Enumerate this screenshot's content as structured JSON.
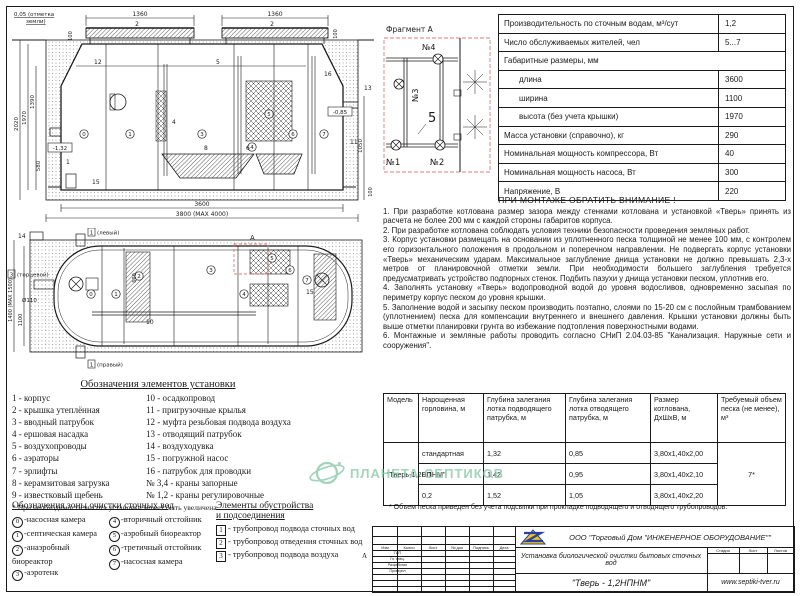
{
  "side_view": {
    "ground1": "0,05 (отметка",
    "ground2": "земли)",
    "dim_top_left": "1360",
    "dim_top_right": "1360",
    "lid_left": "2",
    "lid_right": "2",
    "d100l": "100",
    "d100r": "100",
    "d2020": "2020",
    "d1970": "1970",
    "d1390": "1390",
    "d580": "580",
    "inlet_depth": "-1,32",
    "outlet_depth": "-0,85",
    "d1050": "1050",
    "d100br": "100",
    "d3600": "3600",
    "d3800": "3800 (МАХ 4000)",
    "labels": {
      "n12": "12",
      "n5": "5",
      "n16": "16",
      "n13": "13",
      "n11": "11",
      "n1": "1",
      "n15": "15",
      "n4": "4",
      "n8": "8",
      "n6": "6"
    }
  },
  "plan_view": {
    "d1400": "1400 (МАХ 1500)",
    "d1100": "1100",
    "d600": "600",
    "dia110": "Ø110",
    "n14": "14",
    "n10": "10",
    "n15": "15",
    "end_num": "3",
    "end_label": "(торцевой)",
    "top_num": "1",
    "top_label": "(левый)",
    "bottom_num": "1",
    "bottom_label": "(правый)",
    "mark": "А"
  },
  "fragment": {
    "title": "Фрагмент А",
    "v1": "№1",
    "v2": "№2",
    "v3": "№3",
    "v4": "№4",
    "n5": "5"
  },
  "spec_table": {
    "rows": [
      {
        "label": "Производительность по сточным водам, м³/сут",
        "value": "1,2"
      },
      {
        "label": "Число обслуживаемых жителей, чел",
        "value": "5...7"
      },
      {
        "label": "Габаритные размеры, мм",
        "value": ""
      },
      {
        "label": "длина",
        "value": "3600"
      },
      {
        "label": "ширина",
        "value": "1100"
      },
      {
        "label": "высота (без учета крышки)",
        "value": "1970"
      },
      {
        "label": "Масса установки (справочно), кг",
        "value": "290"
      },
      {
        "label": "Номинальная мощность компрессора, Вт",
        "value": "40"
      },
      {
        "label": "Номинальная мощность насоса, Вт",
        "value": "300"
      },
      {
        "label": "Напряжение, В",
        "value": "220"
      }
    ]
  },
  "notice": {
    "title": "ПРИ МОНТАЖЕ ОБРАТИТЬ ВНИМАНИЕ !",
    "paragraphs": [
      "1. При разработке котлована размер зазора между стенками котлована и установкой «Тверь» принять из расчета не более 200 мм с каждой стороны габаритов корпуса.",
      "2. При разработке котлована соблюдать условия техники безопасности проведения земляных работ.",
      "3. Корпус установки размещать на основании из уплотненного песка толщиной не менее 100 мм, с контролем его горизонтального положения в продольном и поперечном направлении. Не подвергать корпус установки «Тверь» механическим ударам. Максимальное заглубление днища установки не должно превышать 2,3-х метров от планировочной отметки земли. При необходимости большего заглубления требуется предусматривать устройство подпорных стенок.  Подбить пазухи у днища установки песком, уплотнив его.",
      "4. Заполнять установку «Тверь» водопроводной водой до уровня водосливов, одновременно засыпая по периметру корпус песком до уровня крышки.",
      "5. Заполнение водой и засыпку песком производить поэтапно, слоями по 15-20 см с послойным трамбованием (уплотнением) песка для компенсации внутреннего и внешнего давления. Крышки установки должны быть выше отметки планировки грунта во избежание подтопления поверхностными водами.",
      "6. Монтажные и земляные работы проводить согласно СНиП 2.04.03-85 \"Канализация. Наружные сети и сооружения\"."
    ]
  },
  "legend_elements": {
    "title": "Обозначения элементов установки",
    "col1": [
      "1 - корпус",
      "2 - крышка утеплённая",
      "3 - вводный патрубок",
      "4 - ершовая насадка",
      "5 - воздухопроводы",
      "6 - аэраторы",
      "7 - эрлифты",
      "8 - керамзитовая загрузка",
      "9 - известковый щебень"
    ],
    "col2": [
      "10 - осадкопровод",
      "11 - пригрузочные крылья",
      "12 - муфта резьбовая подвода воздуха",
      "13 - отводящий патрубок",
      "14 - воздуходувка",
      "15 - погружной насос",
      "16 - патрубок для проводки",
      "№ 3,4 - краны запорные",
      "№ 1,2 - краны регулировочные"
    ],
    "footnote": "* При необходимости высота установки может быть увеличена"
  },
  "legend_zones": {
    "title": "Обозначения зоны очистки сточных вод",
    "items": [
      {
        "num": "0",
        "label": "-насосная камера"
      },
      {
        "num": "1",
        "label": "-септическая камера"
      },
      {
        "num": "2",
        "label": "-анаэробный биореактор"
      },
      {
        "num": "3",
        "label": "-аэротенк"
      },
      {
        "num": "4",
        "label": "-вторичный отстойник"
      },
      {
        "num": "5",
        "label": "-аэробный биореактор"
      },
      {
        "num": "6",
        "label": "-третичный отстойник"
      },
      {
        "num": "7",
        "label": "-насосная камера"
      }
    ]
  },
  "legend_fittings": {
    "title_line1": "Элементы обустройства",
    "title_line2": "и подсоединения",
    "items": [
      {
        "num": "1",
        "label": "- трубопровод подвода сточных вод"
      },
      {
        "num": "2",
        "label": "- трубопровод отведения сточных вод"
      },
      {
        "num": "3",
        "label": "- трубопровод подвода воздуха"
      }
    ]
  },
  "model_table": {
    "headers": [
      "Модель",
      "Нарощенная горловина, м",
      "Глубина залегания лотка подводящего патрубка, м",
      "Глубина залегания лотка отводящего патрубка, м",
      "Размер котлована, ДхШхВ, м",
      "Требуемый объем песка (не менее), м³"
    ],
    "model": "\"Тверь-1,2НПНМ\"",
    "rows": [
      [
        "стандартная",
        "1,32",
        "0,85",
        "3,80х1,40х2,00"
      ],
      [
        "0,1",
        "1,42",
        "0,95",
        "3,80х1,40х2,10"
      ],
      [
        "0,2",
        "1,52",
        "1,05",
        "3,80х1,40х2,20"
      ]
    ],
    "sand_volume": "7*",
    "footnote": "* Объем песка приведен без учета подсыпки при прокладке подводящего и отводящего трубопроводов."
  },
  "title_block": {
    "company": "ООО \"Торговый Дом \"ИНЖЕНЕРНОЕ ОБОРУДОВАНИЕ\"\"",
    "description": "Установка биологической очистки бытовых сточных вод",
    "model": "\"Тверь - 1,2НПНМ\"",
    "website": "www.septiki-tver.ru",
    "stamp_cols": [
      "Изм",
      "Колич",
      "Лист",
      "№ док",
      "Подпись",
      "Дата"
    ],
    "side_rows": [
      "ГИП",
      "Гл. спец.",
      "Разработал",
      "Проверил"
    ],
    "small_cols": [
      "Стадия",
      "Лист",
      "Листов"
    ],
    "zone_marker": "А"
  },
  "watermark": {
    "text": "ПЛАНЕТА СЕПТИКОВ"
  }
}
